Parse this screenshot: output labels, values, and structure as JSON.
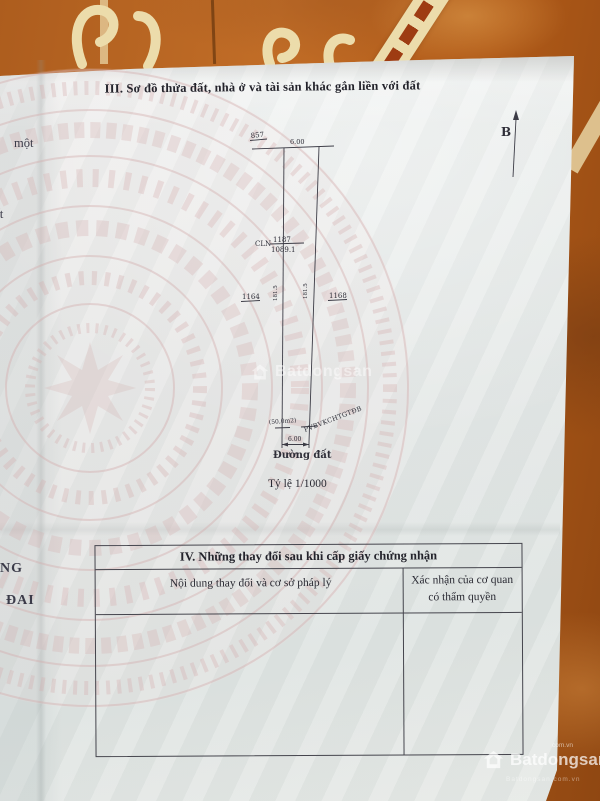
{
  "document": {
    "section_iii_title": "III. Sơ đồ thửa đất, nhà ở và tài sản khác gắn liền với đất",
    "north_label": "B",
    "scale_label": "Tỷ lệ 1/1000"
  },
  "plot_diagram": {
    "adjacent_plot_top": "857",
    "top_width": "6.00",
    "land_use_code": "CLN",
    "plot_number": "1187",
    "plot_area": "1089.1",
    "adjacent_plot_left": "1164",
    "adjacent_plot_right": "1168",
    "left_side_length": "181.5",
    "right_side_length": "181.5",
    "corridor_area": "(50,0m2)",
    "corridor_label": "PVBVKCHTGTĐB",
    "bottom_width": "6.00",
    "road_label": "Đường đất"
  },
  "section_iv_table": {
    "title": "IV. Những thay đổi sau khi cấp giấy chứng nhận",
    "columns": [
      {
        "label": "Nội dung thay đổi và cơ sở pháp lý"
      },
      {
        "label_line1": "Xác nhận của cơ quan",
        "label_line2": "có thẩm quyền"
      }
    ]
  },
  "left_page_fragments": {
    "frag1": "một",
    "frag2": "ất",
    "frag3": "NG",
    "frag4": "ĐAI"
  },
  "watermarks": {
    "center_text": "Batdongsan",
    "corner_text": "Batdongsan",
    "corner_suffix": "com.vn",
    "corner_subtext": "Batdongsan.com.vn"
  },
  "colors": {
    "tile": "#b05c1e",
    "tile_dark": "#8f4712",
    "ornament_cream": "#ecdcab",
    "paper": "#e8ebeb",
    "ink": "#2a2a33",
    "drum_watermark": "#d9b6b6"
  }
}
